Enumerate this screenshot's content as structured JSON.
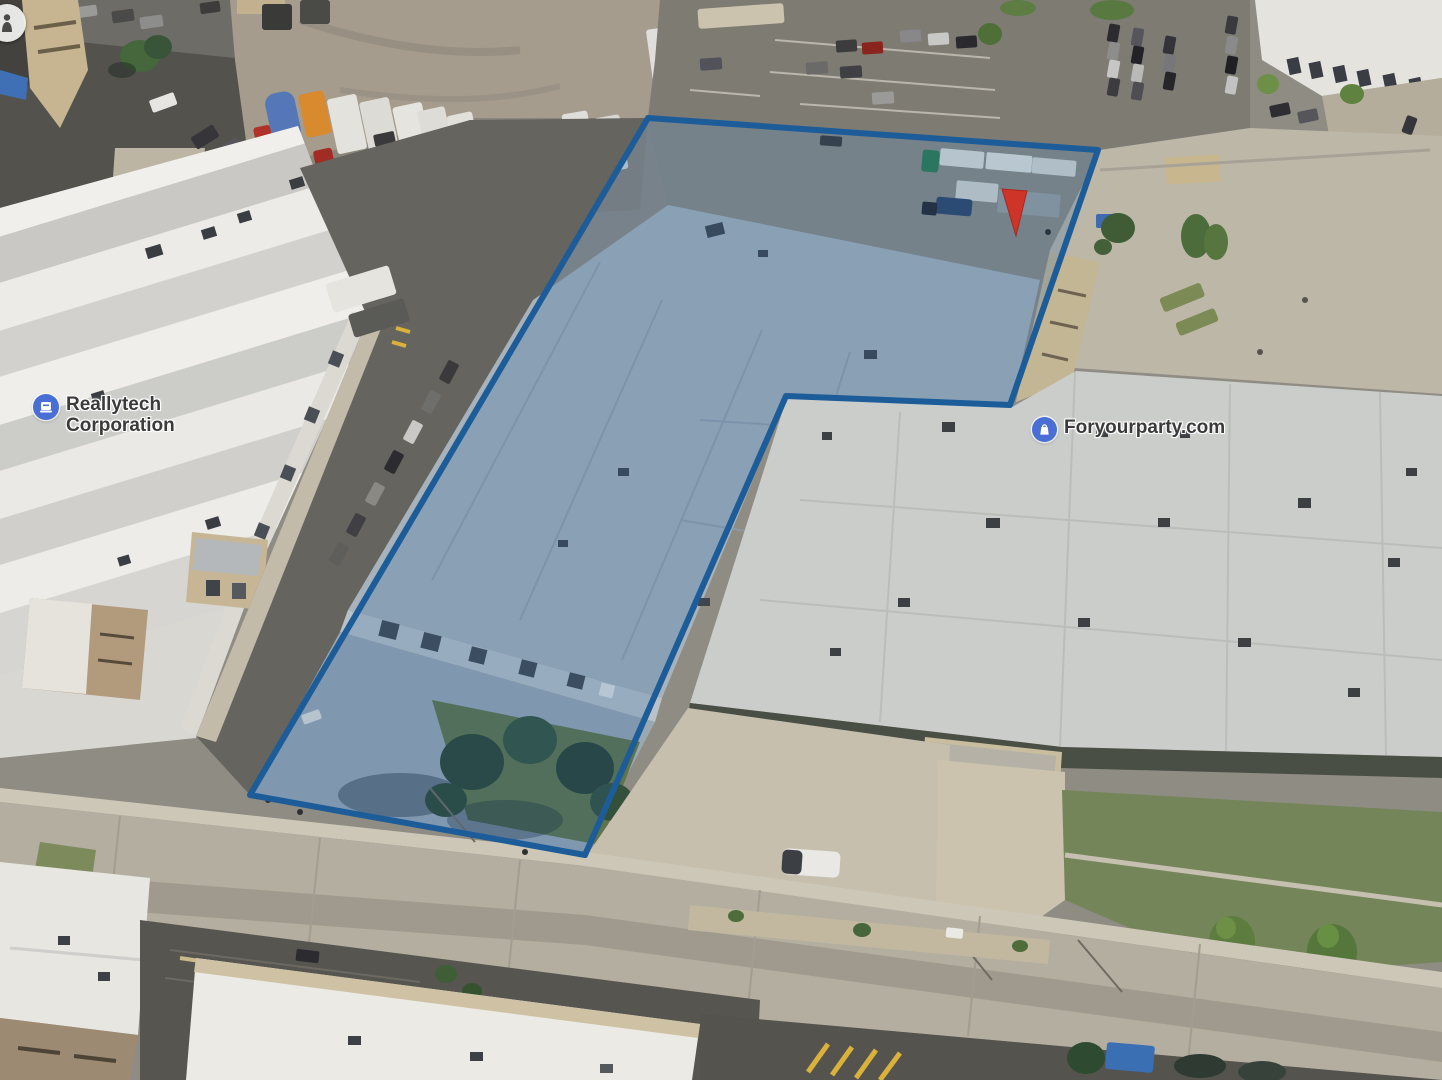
{
  "view": {
    "type": "3d-aerial-imagery",
    "description": "Oblique aerial view of an industrial block with a highlighted parcel"
  },
  "labels": {
    "reallytech": {
      "line1": "Reallytech",
      "line2": "Corporation",
      "icon": "office-building-icon",
      "icon_bg": "#4a6fd4"
    },
    "foryourparty": {
      "text": "Foryourparty.com",
      "icon": "shopping-bag-icon",
      "icon_bg": "#4a6fd4"
    }
  },
  "property_outline": {
    "points": "648,118 1098,150 1010,405 786,396 585,855 250,795",
    "stroke": "#1c5c99",
    "fill": "rgba(36,96,160,0.22)",
    "stroke_width": "6"
  },
  "marker": {
    "name": "red-location-pin",
    "color": "#cf3428",
    "points": "1002,189 1027,191 1016,236"
  },
  "viewer": {
    "name": "street-view-person-icon",
    "color": "#4a4a4a"
  },
  "palette": {
    "asphalt_dark": "#57554f",
    "asphalt_mid": "#7e7b73",
    "gravel": "#a59c8d",
    "concrete": "#bdb7a8",
    "street_concrete": "#b3ae9f",
    "white_roof": "#eceae4",
    "right_building_roof": "#cbcdca",
    "property_roof": "#a7b2ba",
    "lawn": "#75855a",
    "tree_dark": "#2c4531",
    "tree_bright": "#5d7d3f",
    "tan_wall": "#c6b899",
    "trailer_orange": "#d98a2e",
    "trailer_blue": "#5577b8",
    "truck_red": "#b03228",
    "truck_green": "#2e7d4f"
  }
}
